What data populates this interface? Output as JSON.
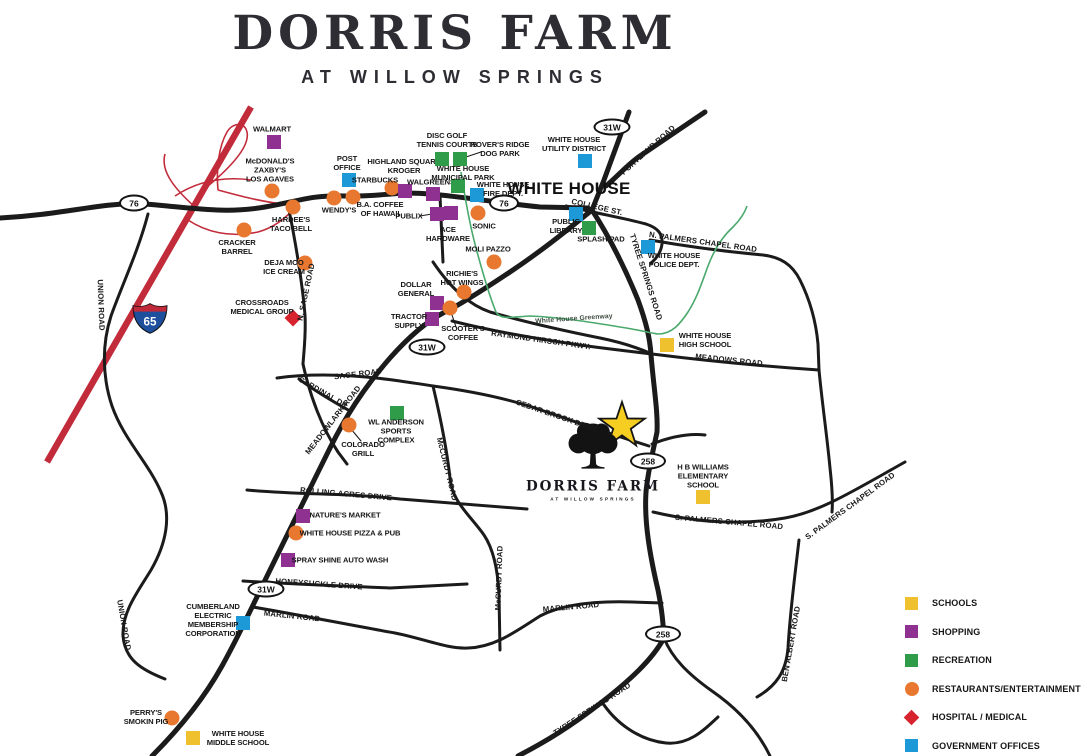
{
  "header": {
    "title": "DORRIS FARM",
    "subtitle": "AT WILLOW SPRINGS"
  },
  "city_label": "WHITE HOUSE",
  "site": {
    "logo_name": "DORRIS FARM",
    "logo_tagline": "AT WILLOW SPRINGS",
    "star": [
      622,
      426
    ],
    "star_color": "#F5CE21"
  },
  "category_styles": {
    "schools": {
      "shape": "square",
      "color": "#F0C12F"
    },
    "shopping": {
      "shape": "square",
      "color": "#8E3190"
    },
    "recreation": {
      "shape": "square",
      "color": "#2E9C48"
    },
    "restaurants": {
      "shape": "circle",
      "color": "#E8782F"
    },
    "medical": {
      "shape": "diamond",
      "color": "#D6232E"
    },
    "government": {
      "shape": "square",
      "color": "#1C99D6"
    }
  },
  "legend": {
    "items": [
      {
        "label": "SCHOOLS",
        "category": "schools"
      },
      {
        "label": "SHOPPING",
        "category": "shopping"
      },
      {
        "label": "RECREATION",
        "category": "recreation"
      },
      {
        "label": "RESTAURANTS/ENTERTAINMENT",
        "category": "restaurants"
      },
      {
        "label": "HOSPITAL / MEDICAL",
        "category": "medical"
      },
      {
        "label": "GOVERNMENT OFFICES",
        "category": "government"
      }
    ]
  },
  "route_shields": [
    {
      "text": "76",
      "x": 134,
      "y": 203,
      "w": 30
    },
    {
      "text": "76",
      "x": 504,
      "y": 203,
      "w": 30
    },
    {
      "text": "31W",
      "x": 612,
      "y": 127,
      "w": 37
    },
    {
      "text": "31W",
      "x": 427,
      "y": 347,
      "w": 37
    },
    {
      "text": "31W",
      "x": 266,
      "y": 589,
      "w": 37
    },
    {
      "text": "258",
      "x": 648,
      "y": 461,
      "w": 36
    },
    {
      "text": "258",
      "x": 663,
      "y": 634,
      "w": 36
    }
  ],
  "interstate_shield": {
    "text": "65",
    "x": 150,
    "y": 321
  },
  "road_labels": [
    {
      "text": "PORTLAND ROAD",
      "x": 648,
      "y": 150,
      "r": -42
    },
    {
      "text": "COLLEGE ST.",
      "x": 597,
      "y": 207,
      "r": 13
    },
    {
      "text": "N. PALMERS CHAPEL ROAD",
      "x": 703,
      "y": 242,
      "r": 8
    },
    {
      "text": "TYREE SPRINGS ROAD",
      "x": 646,
      "y": 277,
      "r": 72
    },
    {
      "text": "MEADOWS ROAD",
      "x": 729,
      "y": 360,
      "r": 6
    },
    {
      "text": "RAYMOND HIRSCH PKWY.",
      "x": 541,
      "y": 340,
      "r": 8
    },
    {
      "text": "White House Greenway",
      "x": 574,
      "y": 319,
      "r": -4,
      "cls": "greenway"
    },
    {
      "text": "SAGE ROAD",
      "x": 358,
      "y": 374,
      "r": -7
    },
    {
      "text": "CARDINAL DR.",
      "x": 324,
      "y": 393,
      "r": 30
    },
    {
      "text": "MEADOWLARK ROAD",
      "x": 333,
      "y": 420,
      "r": -52
    },
    {
      "text": "N. SAGE ROAD",
      "x": 306,
      "y": 292,
      "r": -78
    },
    {
      "text": "McCURDY ROAD",
      "x": 447,
      "y": 469,
      "r": 76
    },
    {
      "text": "McCURDY ROAD",
      "x": 499,
      "y": 578,
      "r": -88
    },
    {
      "text": "ROLLING ACRES DRIVE",
      "x": 346,
      "y": 494,
      "r": 5
    },
    {
      "text": "HONEYSUCKLE DRIVE",
      "x": 319,
      "y": 584,
      "r": 4
    },
    {
      "text": "MARLIN ROAD",
      "x": 292,
      "y": 616,
      "r": 6
    },
    {
      "text": "MARLIN ROAD",
      "x": 571,
      "y": 607,
      "r": -5
    },
    {
      "text": "UNION ROAD",
      "x": 101,
      "y": 305,
      "r": 88
    },
    {
      "text": "UNION ROAD",
      "x": 124,
      "y": 625,
      "r": 80
    },
    {
      "text": "CEDAR BROOK DRIVE",
      "x": 557,
      "y": 416,
      "r": 19
    },
    {
      "text": "S. PALMERS CHAPEL ROAD",
      "x": 729,
      "y": 522,
      "r": 5
    },
    {
      "text": "S. PALMERS CHAPEL ROAD",
      "x": 850,
      "y": 506,
      "r": -36
    },
    {
      "text": "BEN ALBERT ROAD",
      "x": 791,
      "y": 644,
      "r": -80
    },
    {
      "text": "TYREE SPRINGS ROAD",
      "x": 592,
      "y": 709,
      "r": -33
    }
  ],
  "pois": [
    {
      "id": "walmart",
      "lines": [
        "WALMART"
      ],
      "category": "shopping",
      "marker": [
        274,
        142
      ],
      "label": [
        272,
        130
      ]
    },
    {
      "id": "mcdonalds-zaxbys-los-agaves",
      "lines": [
        "McDONALD'S",
        "ZAXBY'S",
        "LOS AGAVES"
      ],
      "category": "restaurants",
      "marker": [
        272,
        191
      ],
      "label": [
        270,
        171
      ]
    },
    {
      "id": "hardees-taco-bell",
      "lines": [
        "HARDEE'S",
        "TACO BELL"
      ],
      "category": "restaurants",
      "marker": [
        293,
        207
      ],
      "label": [
        291,
        225
      ]
    },
    {
      "id": "cracker-barrel",
      "lines": [
        "CRACKER",
        "BARREL"
      ],
      "category": "restaurants",
      "marker": [
        244,
        230
      ],
      "label": [
        237,
        248
      ]
    },
    {
      "id": "wendys",
      "lines": [
        "WENDY'S"
      ],
      "category": "restaurants",
      "marker": [
        334,
        198
      ],
      "label": [
        339,
        211
      ]
    },
    {
      "id": "ba-coffee-of-hawaii",
      "lines": [
        "B.A. COFFEE",
        "OF HAWAII"
      ],
      "category": "restaurants",
      "marker": [
        353,
        197
      ],
      "label": [
        380,
        210
      ]
    },
    {
      "id": "post-office",
      "lines": [
        "POST",
        "OFFICE"
      ],
      "category": "government",
      "marker": [
        349,
        180
      ],
      "label": [
        347,
        164
      ]
    },
    {
      "id": "starbucks",
      "lines": [
        "STARBUCKS"
      ],
      "category": "restaurants",
      "marker": [
        392,
        188
      ],
      "label": [
        375,
        181
      ]
    },
    {
      "id": "highland-square-kroger",
      "lines": [
        "HIGHLAND SQUARE",
        "KROGER"
      ],
      "category": "shopping",
      "marker": [
        405,
        191
      ],
      "label": [
        404,
        167
      ]
    },
    {
      "id": "walgreens",
      "lines": [
        "WALGREENS"
      ],
      "category": "shopping",
      "marker": [
        433,
        194
      ],
      "label": [
        431,
        183
      ]
    },
    {
      "id": "disc-golf-tennis-courts",
      "lines": [
        "DISC GOLF",
        "TENNIS COURTS"
      ],
      "category": "recreation",
      "marker": [
        442,
        159
      ],
      "label": [
        447,
        141
      ]
    },
    {
      "id": "rovers-ridge-dog-park",
      "lines": [
        "ROVER'S RIDGE",
        "DOG PARK"
      ],
      "category": "recreation",
      "marker": [
        460,
        159
      ],
      "label": [
        500,
        150
      ]
    },
    {
      "id": "white-house-municipal-park",
      "lines": [
        "WHITE HOUSE",
        "MUNICIPAL PARK"
      ],
      "category": "recreation",
      "marker": [
        458,
        186
      ],
      "label": [
        463,
        174
      ]
    },
    {
      "id": "white-house-fire-dept",
      "lines": [
        "WHITE HOUSE",
        "FIRE DEPT."
      ],
      "category": "government",
      "marker": [
        477,
        195
      ],
      "label": [
        503,
        190
      ]
    },
    {
      "id": "publix",
      "lines": [
        "PUBLIX"
      ],
      "category": "shopping",
      "marker": [
        437,
        214
      ],
      "label": [
        409,
        217
      ]
    },
    {
      "id": "ace-hardware",
      "lines": [
        "ACE",
        "HARDWARE"
      ],
      "category": "shopping",
      "marker": [
        451,
        213
      ],
      "label": [
        448,
        235
      ]
    },
    {
      "id": "sonic",
      "lines": [
        "SONIC"
      ],
      "category": "restaurants",
      "marker": [
        478,
        213
      ],
      "label": [
        484,
        227
      ]
    },
    {
      "id": "moli-pazzo",
      "lines": [
        "MOLI PAZZO"
      ],
      "category": "restaurants",
      "marker": [
        494,
        262
      ],
      "label": [
        488,
        250
      ]
    },
    {
      "id": "deja-moo-ice-cream",
      "lines": [
        "DEJA MOO",
        "ICE CREAM"
      ],
      "category": "restaurants",
      "marker": [
        305,
        263
      ],
      "label": [
        284,
        268
      ]
    },
    {
      "id": "crossroads-medical-group",
      "lines": [
        "CROSSROADS",
        "MEDICAL GROUP"
      ],
      "category": "medical",
      "marker": [
        293,
        318
      ],
      "label": [
        262,
        308
      ]
    },
    {
      "id": "richies-hot-wings",
      "lines": [
        "RICHIE'S",
        "HOT WINGS"
      ],
      "category": "restaurants",
      "marker": [
        464,
        292
      ],
      "label": [
        462,
        279
      ]
    },
    {
      "id": "dollar-general",
      "lines": [
        "DOLLAR",
        "GENERAL"
      ],
      "category": "shopping",
      "marker": [
        437,
        303
      ],
      "label": [
        416,
        290
      ]
    },
    {
      "id": "scooters-coffee",
      "lines": [
        "SCOOTER'S",
        "COFFEE"
      ],
      "category": "restaurants",
      "marker": [
        450,
        308
      ],
      "label": [
        463,
        334
      ]
    },
    {
      "id": "tractor-supply",
      "lines": [
        "TRACTOR",
        "SUPPLY"
      ],
      "category": "shopping",
      "marker": [
        432,
        319
      ],
      "label": [
        409,
        322
      ]
    },
    {
      "id": "white-house-utility-district",
      "lines": [
        "WHITE HOUSE",
        "UTILITY DISTRICT"
      ],
      "category": "government",
      "marker": [
        585,
        161
      ],
      "label": [
        574,
        145
      ]
    },
    {
      "id": "public-library",
      "lines": [
        "PUBLIC",
        "LIBRARY"
      ],
      "category": "government",
      "marker": [
        576,
        214
      ],
      "label": [
        566,
        227
      ]
    },
    {
      "id": "splash-pad",
      "lines": [
        "SPLASH PAD"
      ],
      "category": "recreation",
      "marker": [
        589,
        228
      ],
      "label": [
        601,
        240
      ]
    },
    {
      "id": "white-house-police-dept",
      "lines": [
        "WHITE HOUSE",
        "POLICE DEPT."
      ],
      "category": "government",
      "marker": [
        648,
        247
      ],
      "label": [
        674,
        261
      ]
    },
    {
      "id": "white-house-high-school",
      "lines": [
        "WHITE HOUSE",
        "HIGH SCHOOL"
      ],
      "category": "schools",
      "marker": [
        667,
        345
      ],
      "label": [
        705,
        341
      ]
    },
    {
      "id": "hb-williams-elementary",
      "lines": [
        "H B WILLIAMS",
        "ELEMENTARY",
        "SCHOOL"
      ],
      "category": "schools",
      "marker": [
        703,
        497
      ],
      "label": [
        703,
        477
      ]
    },
    {
      "id": "wl-anderson-sports-complex",
      "lines": [
        "WL ANDERSON",
        "SPORTS",
        "COMPLEX"
      ],
      "category": "recreation",
      "marker": [
        397,
        413
      ],
      "label": [
        396,
        432
      ]
    },
    {
      "id": "colorado-grill",
      "lines": [
        "COLORADO",
        "GRILL"
      ],
      "category": "restaurants",
      "marker": [
        349,
        425
      ],
      "label": [
        363,
        450
      ]
    },
    {
      "id": "natures-market",
      "lines": [
        "NATURE'S MARKET"
      ],
      "category": "shopping",
      "marker": [
        303,
        516
      ],
      "label": [
        345,
        516
      ]
    },
    {
      "id": "white-house-pizza-pub",
      "lines": [
        "WHITE HOUSE PIZZA & PUB"
      ],
      "category": "restaurants",
      "marker": [
        296,
        533
      ],
      "label": [
        350,
        534
      ]
    },
    {
      "id": "spray-shine-auto-wash",
      "lines": [
        "SPRAY SHINE AUTO WASH"
      ],
      "category": "shopping",
      "marker": [
        288,
        560
      ],
      "label": [
        340,
        561
      ]
    },
    {
      "id": "cumberland-electric",
      "lines": [
        "CUMBERLAND",
        "ELECTRIC",
        "MEMBERSHIP",
        "CORPORATION"
      ],
      "category": "government",
      "marker": [
        243,
        623
      ],
      "label": [
        213,
        621
      ]
    },
    {
      "id": "perrys-smokin-pig",
      "lines": [
        "PERRY'S",
        "SMOKIN PIG"
      ],
      "category": "restaurants",
      "marker": [
        172,
        718
      ],
      "label": [
        146,
        718
      ]
    },
    {
      "id": "white-house-middle-school",
      "lines": [
        "WHITE HOUSE",
        "MIDDLE SCHOOL"
      ],
      "category": "schools",
      "marker": [
        193,
        738
      ],
      "label": [
        238,
        739
      ]
    }
  ]
}
